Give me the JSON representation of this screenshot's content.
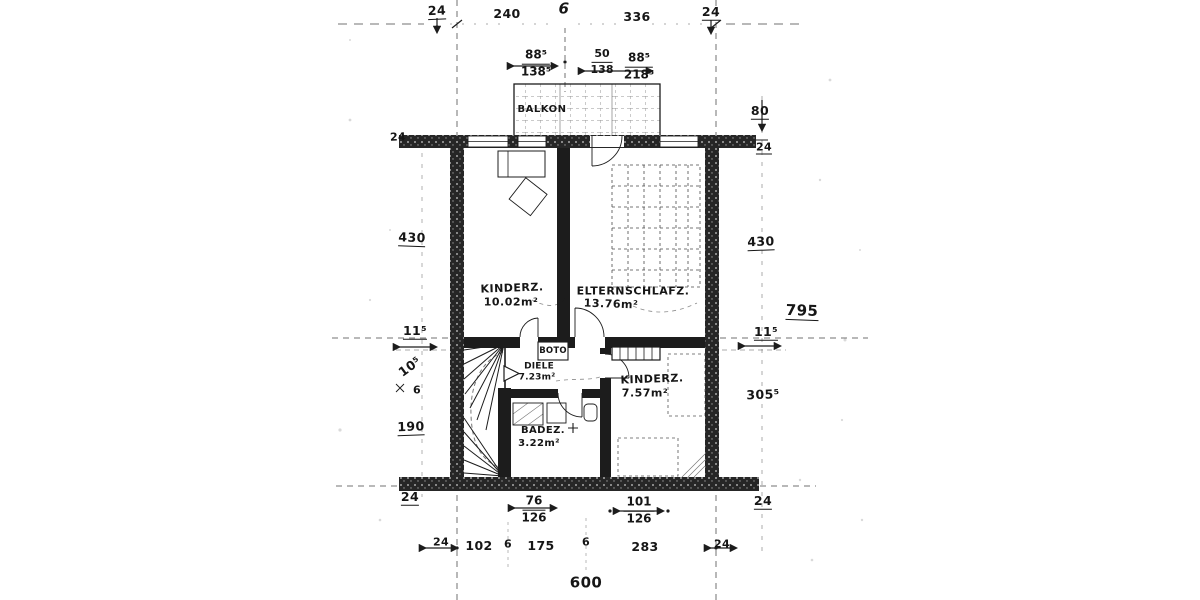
{
  "drawing": {
    "kind": "scanned hand-drawn floor plan (upper storey)",
    "ink_color": "#1c1c1c",
    "paper_color": "#ffffff"
  },
  "rooms": {
    "balkon": {
      "label": "BALKON"
    },
    "kinderz1": {
      "label": "KINDERZ.",
      "area": "10.02m²"
    },
    "eltern": {
      "label": "ELTERNSCHLAFZ.",
      "area": "13.76m²"
    },
    "boto": {
      "label": "BOTO"
    },
    "diele": {
      "label": "DIELE",
      "area": "7.23m²"
    },
    "kinderz2": {
      "label": "KINDERZ.",
      "area": "7.57m²"
    },
    "badez": {
      "label": "BADEZ.",
      "area": "3.22m²"
    }
  },
  "dims": {
    "top": {
      "left24": "24",
      "w240": "240",
      "axis6": "6",
      "w336": "336",
      "right24": "24"
    },
    "fractions_top": [
      {
        "num": "88⁵",
        "den": "138⁵"
      },
      {
        "num": "50",
        "den": "138"
      },
      {
        "num": "88⁵",
        "den": "218⁵"
      }
    ],
    "left": {
      "wall24": "24",
      "h430": "430",
      "h115": "11⁵",
      "h105": "10⁵",
      "h6": "6",
      "h190": "190",
      "wall24b": "24",
      "row24": "24"
    },
    "right": {
      "h80": "80",
      "wall24": "24",
      "h430": "430",
      "total795": "795",
      "h115": "11⁵",
      "h3055": "305⁵",
      "wall24b": "24",
      "row24": "24"
    },
    "bottom": {
      "fractions": [
        {
          "num": "76",
          "den": "126"
        },
        {
          "num": "101",
          "den": "126"
        }
      ],
      "row": [
        "102",
        "6",
        "175",
        "6",
        "283"
      ],
      "total": "600"
    }
  }
}
